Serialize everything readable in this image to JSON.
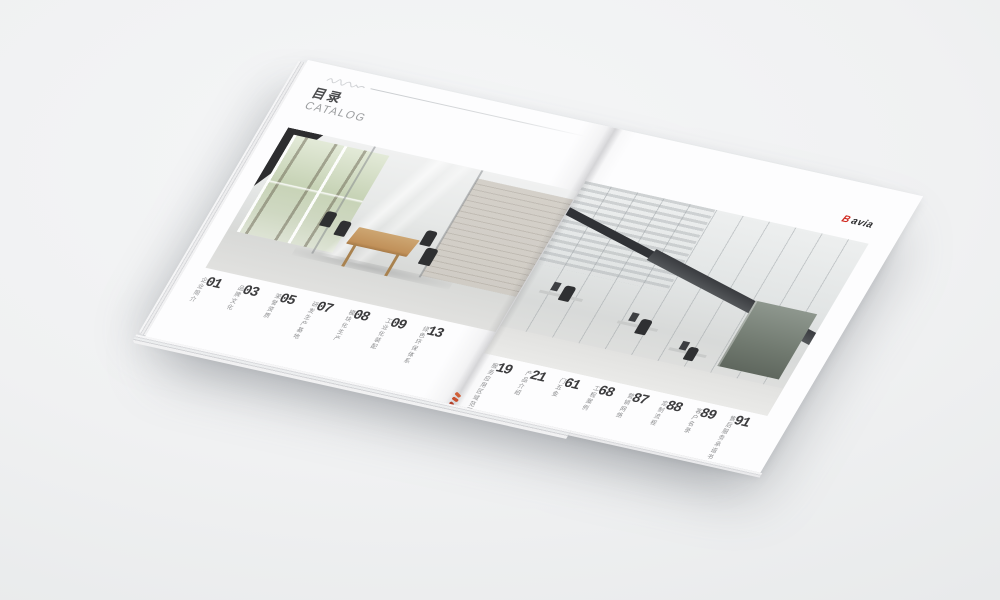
{
  "catalog": {
    "title": "目录",
    "subtitle": "CATALOG",
    "brand": {
      "mark": "B",
      "name": "avia",
      "accent_color": "#d0281f",
      "text_color": "#2e2e30"
    },
    "toc_left": [
      {
        "num": "01",
        "label": "企业简介"
      },
      {
        "num": "03",
        "label": "品牌文化"
      },
      {
        "num": "05",
        "label": "荣誉资质"
      },
      {
        "num": "07",
        "label": "研发生产基地"
      },
      {
        "num": "08",
        "label": "模块化生产"
      },
      {
        "num": "09",
        "label": "工业化装配"
      },
      {
        "num": "13",
        "label": "绿色环保体系"
      }
    ],
    "toc_right": [
      {
        "num": "19",
        "label": "服务应用区域范围"
      },
      {
        "num": "21",
        "label": "产品介绍"
      },
      {
        "num": "61",
        "label": "门五金"
      },
      {
        "num": "68",
        "label": "工程案例"
      },
      {
        "num": "87",
        "label": "营销网络"
      },
      {
        "num": "88",
        "label": "定制流程"
      },
      {
        "num": "89",
        "label": "客户名录"
      },
      {
        "num": "91",
        "label": "售后服务承诺书"
      }
    ],
    "colors": {
      "page": "#fcfcfd",
      "background": "#eef0f1",
      "accent_red": "#d0281f"
    }
  }
}
